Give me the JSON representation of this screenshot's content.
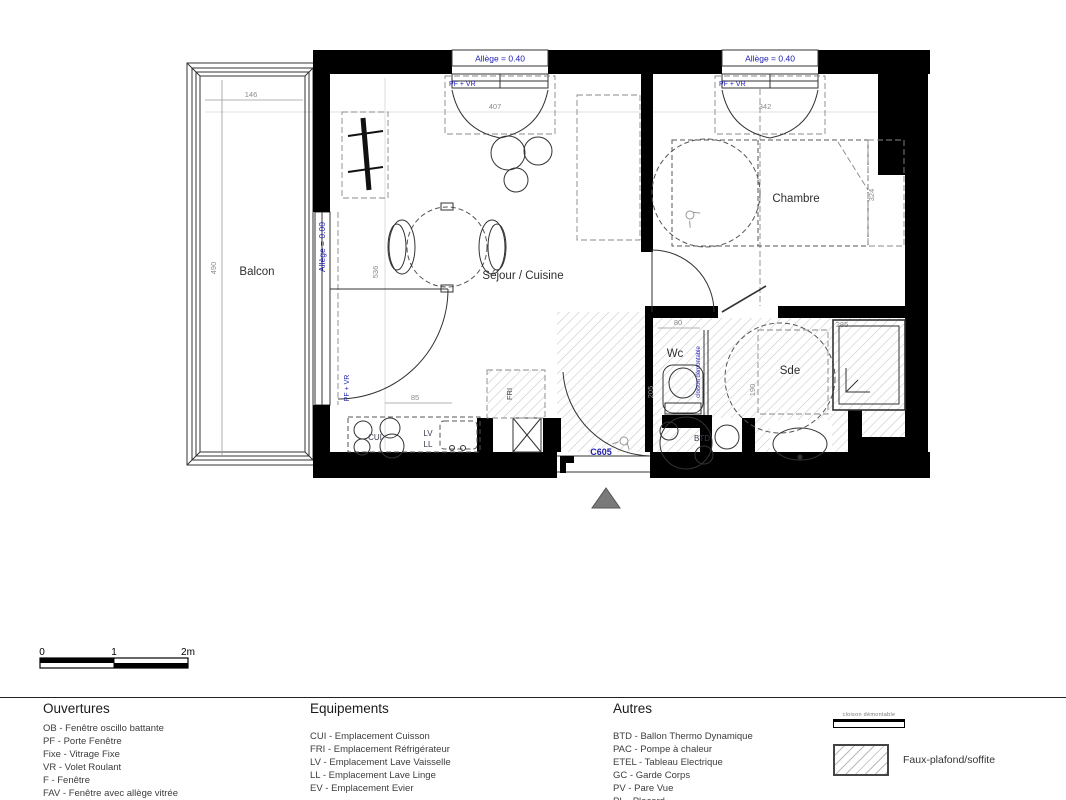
{
  "plan": {
    "windows": [
      {
        "allege": "Allège = 0.40",
        "type": "PF + VR",
        "width": "407"
      },
      {
        "allege": "Allège = 0.40",
        "type": "PF + VR",
        "width": "342"
      }
    ],
    "balcony": {
      "label": "Balcon",
      "dim_width": "146",
      "dim_depth": "490"
    },
    "balcony_door": {
      "allege": "Allège = 0.00",
      "type": "PF + VR"
    },
    "rooms": {
      "sejour": "Séjour / Cuisine",
      "chambre": "Chambre",
      "wc": "Wc",
      "sde": "Sde"
    },
    "dims": {
      "sejour_depth": "536",
      "kitchen": "85",
      "chambre_depth": "324",
      "wc_width": "80",
      "wc_depth": "205",
      "sde_corridor": "190",
      "sde_width": "285"
    },
    "equipment": {
      "cui": "CUI",
      "lv": "LV",
      "ll": "LL",
      "fri": "FRI",
      "btd": "BTD"
    },
    "door_code": "C605",
    "cloison": "cloison démontable"
  },
  "scalebar": {
    "zero": "0",
    "one": "1",
    "two": "2m"
  },
  "legend": {
    "ouvertures": {
      "title": "Ouvertures",
      "items": [
        "OB - Fenêtre oscillo battante",
        "PF - Porte Fenêtre",
        "Fixe - Vitrage Fixe",
        "VR - Volet Roulant",
        "F - Fenêtre",
        "FAV - Fenêtre avec allège vitrée",
        "VRE - Volet Roulant Electrique"
      ]
    },
    "equipements": {
      "title": "Equipements",
      "items": [
        "CUI - Emplacement Cuisson",
        "FRI - Emplacement Réfrigérateur",
        "LV - Emplacement Lave Vaisselle",
        "LL - Emplacement Lave Linge",
        "EV - Emplacement Evier"
      ]
    },
    "autres": {
      "title": "Autres",
      "items": [
        "BTD - Ballon Thermo Dynamique",
        "PAC - Pompe à chaleur",
        "ETEL - Tableau Electrique",
        "GC - Garde Corps",
        "PV - Pare Vue",
        "PL - Placard"
      ]
    },
    "symbols": {
      "cloison": "cloison démontable",
      "faux_plafond": "Faux-plafond/soffite"
    }
  }
}
